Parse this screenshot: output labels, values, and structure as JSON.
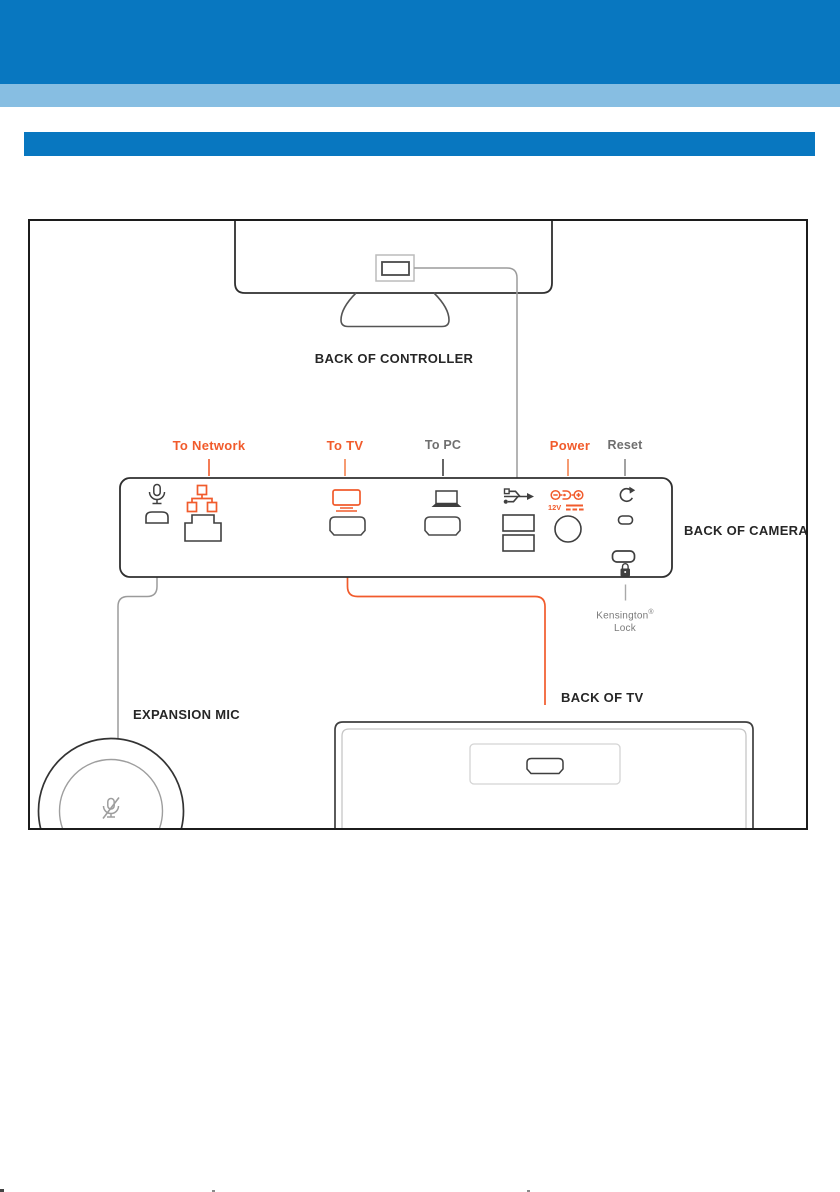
{
  "colors": {
    "brand_blue": "#0877c0",
    "light_blue": "#87bee2",
    "accent_orange": "#f15b2c",
    "dark_text": "#262626",
    "gray_text": "#6f6f6f",
    "line_gray": "#9b9b9b"
  },
  "diagram": {
    "controller_label": "BACK OF CONTROLLER",
    "camera_label": "BACK OF CAMERA",
    "expansion_mic_label": "EXPANSION MIC",
    "tv_label": "BACK OF TV",
    "port_labels": [
      {
        "text": "To Network",
        "color": "#f15b2c"
      },
      {
        "text": "To TV",
        "color": "#f15b2c"
      },
      {
        "text": "To PC",
        "color": "#6f6f6f"
      },
      {
        "text": "Power",
        "color": "#f15b2c"
      },
      {
        "text": "Reset",
        "color": "#6f6f6f"
      }
    ],
    "power_voltage_label": "12V",
    "kensington_label": {
      "line1": "Kensington",
      "registered_mark": "®",
      "line2": "Lock"
    },
    "icons": [
      "microphone-icon",
      "network-icon",
      "tv-icon",
      "pc-icon",
      "usb-icon",
      "power-icon",
      "reset-icon",
      "kensington-lock-icon",
      "mic-mute-icon",
      "hdmi-port",
      "usb-port",
      "rj45-port",
      "power-jack",
      "reset-pinhole",
      "kensington-slot"
    ]
  }
}
